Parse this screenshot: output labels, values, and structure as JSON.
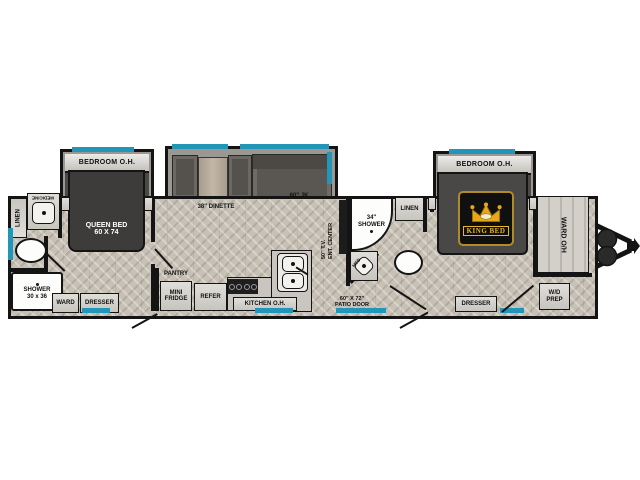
{
  "title": "Travel trailer floor plan",
  "colors": {
    "window": "#2196b8",
    "wall": "#141414",
    "floor": "#c7c0b5",
    "gold": "#e8b62a",
    "bed_dark": "#3d3c3b"
  },
  "labels": {
    "bedroom_oh_left": "BEDROOM O.H.",
    "bedroom_oh_right": "BEDROOM O.H.",
    "dinette": "38\" DINETTE",
    "jk_sofa": "60\" JK",
    "linen_rear": "LINEN",
    "medicine": "MEDICINE",
    "shower_rear_l1": "SHOWER",
    "shower_rear_l2": "30 x 36",
    "queen_l1": "QUEEN BED",
    "queen_l2": "60 X 74",
    "ward": "WARD",
    "dresser_left": "DRESSER",
    "pantry": "PANTRY",
    "fridge_l1": "MINI",
    "fridge_l2": "FRIDGE",
    "refer": "REFER",
    "kitchen_oh": "KITCHEN O.H.",
    "tv_l1": "50\" T.V.",
    "tv_l2": "ENT. CENTER",
    "shower_mid_l1": "34\"",
    "shower_mid_l2": "SHOWER",
    "linen_mid": "LINEN",
    "med": "MED",
    "patio_l1": "60\" X 72\"",
    "patio_l2": "PATIO DOOR",
    "king_bed": "KING BED",
    "dresser_right": "DRESSER",
    "ward_oh": "WARD O/H",
    "wd_l1": "W/D",
    "wd_l2": "PREP"
  }
}
